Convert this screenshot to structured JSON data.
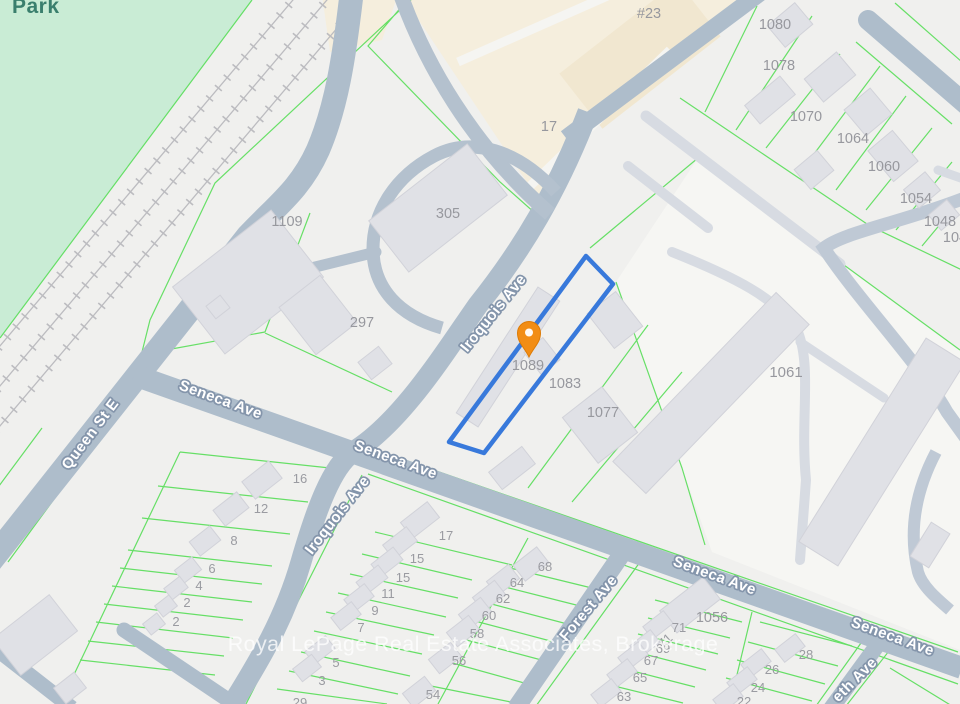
{
  "map": {
    "park_label": "Park",
    "watermark": "Royal LePage Real Estate Associates, Brokerage",
    "subject_property": {
      "lot_number": "1089",
      "highlight_color": "#3879DB",
      "pin_icon": "location-pin",
      "pin_color": "#F28D15"
    },
    "streets": {
      "queen": "Queen St E",
      "seneca": "Seneca Ave",
      "iroquois": "Iroquois Ave",
      "forest": "Forest Ave",
      "elizabeth_partial": "eth Ave"
    },
    "lot_numbers": [
      "#23",
      "17",
      "305",
      "1109",
      "297",
      "1080",
      "1078",
      "1070",
      "1064",
      "1060",
      "1054",
      "1048",
      "104",
      "1061",
      "1083",
      "1077",
      "16",
      "12",
      "8",
      "6",
      "4",
      "2",
      "2",
      "17",
      "15",
      "15",
      "11",
      "9",
      "7",
      "5",
      "3",
      "68",
      "64",
      "62",
      "60",
      "58",
      "56",
      "54",
      "1056",
      "71",
      "71",
      "69",
      "67",
      "65",
      "63",
      "28",
      "26",
      "24",
      "22",
      "29"
    ],
    "colors": {
      "park": "#C9ECD5",
      "road": "#AEBDCB",
      "parcel_line": "#54DD54",
      "building": "#E0E1E6",
      "plaza": "#F5EEDD"
    }
  }
}
